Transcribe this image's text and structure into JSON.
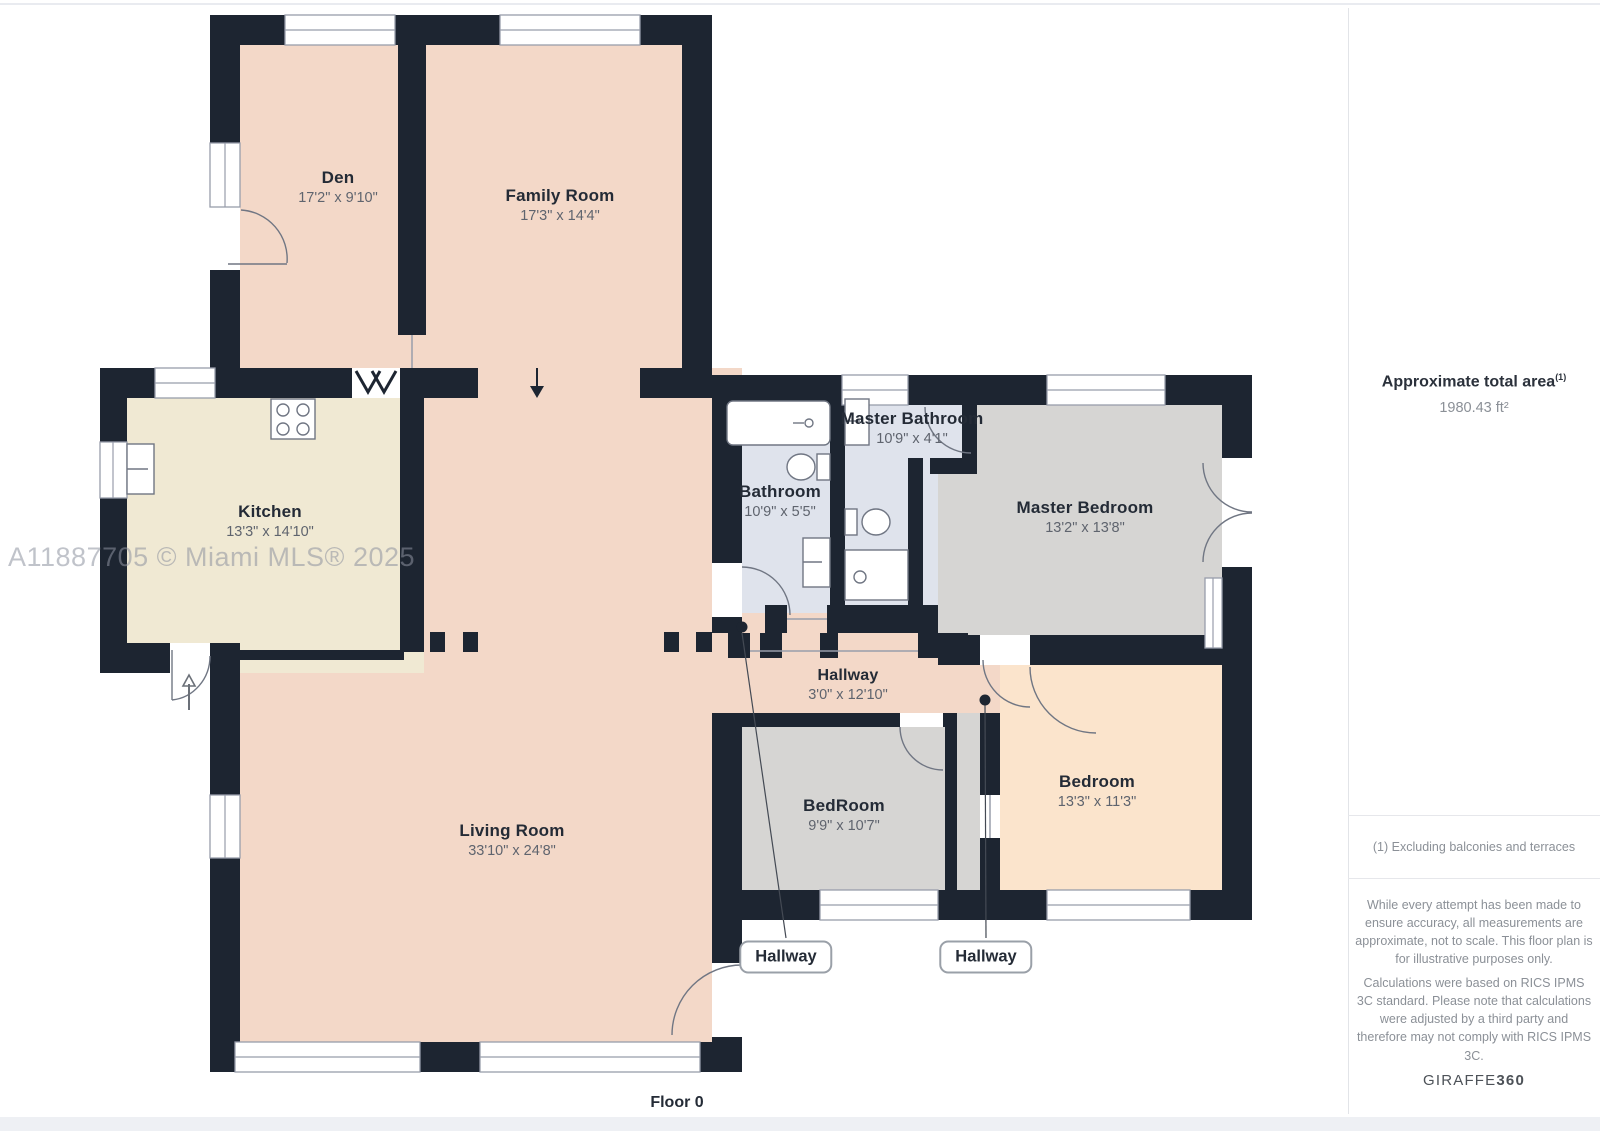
{
  "page": {
    "floor_label": "Floor 0",
    "watermark": "A11887705 © Miami MLS® 2025"
  },
  "rooms": [
    {
      "name": "Den",
      "dims": "17'2\" x 9'10\""
    },
    {
      "name": "Family Room",
      "dims": "17'3\" x 14'4\""
    },
    {
      "name": "Kitchen",
      "dims": "13'3\" x 14'10\""
    },
    {
      "name": "Living Room",
      "dims": "33'10\" x 24'8\""
    },
    {
      "name": "Bathroom",
      "dims": "10'9\" x 5'5\""
    },
    {
      "name": "Master Bathroom",
      "dims": "10'9\" x 4'1\""
    },
    {
      "name": "Master Bedroom",
      "dims": "13'2\" x 13'8\""
    },
    {
      "name": "Hallway",
      "dims": "3'0\" x 12'10\""
    },
    {
      "name": "BedRoom",
      "dims": "9'9\" x 10'7\""
    },
    {
      "name": "Bedroom",
      "dims": "13'3\" x 11'3\""
    }
  ],
  "callouts": [
    {
      "label": "Hallway"
    },
    {
      "label": "Hallway"
    }
  ],
  "sidebar": {
    "area_title": "Approximate total area",
    "area_title_sup": "(1)",
    "area_value": "1980.43 ft²",
    "footnote": "(1) Excluding balconies and terraces",
    "disclaimer1": "While every attempt has been made to ensure accuracy, all measurements are approximate, not to scale. This floor plan is for illustrative purposes only.",
    "disclaimer2": "Calculations were based on RICS IPMS 3C standard. Please note that calculations were adjusted by a third party and therefore may not comply with RICS IPMS 3C.",
    "logo_text": "GIRAFFE",
    "logo_suffix": "360"
  },
  "colors": {
    "wall": "#1d2531",
    "room_salmon": "#f3d8c8",
    "room_cream": "#f0e9d3",
    "room_bath_blue": "#dfe3ec",
    "room_gray": "#d6d5d3",
    "room_peach": "#fbe4cc",
    "label_dark": "#242b36",
    "dims_gray": "#5f646e"
  }
}
